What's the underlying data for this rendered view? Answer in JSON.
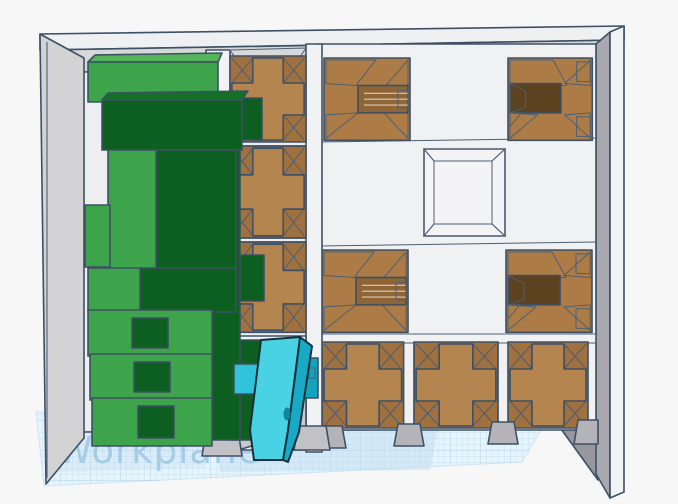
{
  "app": {
    "name": "3d-cad-viewport",
    "background_color": "#f7f7f8",
    "outline_color": "#3d5065"
  },
  "workplane": {
    "label": "Workplane",
    "label_color": "#9dc8e2",
    "grid_line_color": "#bcdcee",
    "grid_base_color": "#e8f4fb"
  },
  "scene": {
    "objects": [
      {
        "name": "storage-tray",
        "description": "open gray tray with compartment grid",
        "wall_color": "#d3d3d5",
        "divider_color": "#f0f1f3"
      },
      {
        "name": "green-stack",
        "description": "stack of interlocking blocks with square holes",
        "light_color": "#3ea44b",
        "dark_color": "#0d5f21"
      },
      {
        "name": "cross-insert",
        "description": "plus-shaped brown inserts in compartments",
        "color": "#b5854f",
        "count": 6
      },
      {
        "name": "socket-block-right-slot",
        "description": "brown block with slot facing right",
        "color": "#ad7c46",
        "count": 2
      },
      {
        "name": "socket-block-left-slot",
        "description": "brown block with dark slot facing left",
        "color": "#ad7c46",
        "cavity_color": "#5d421f",
        "count": 2
      },
      {
        "name": "square-pocket",
        "description": "recessed empty square pocket",
        "wall_color": "#8f8f96"
      },
      {
        "name": "cyan-ramp",
        "description": "cyan angled piece leaning onto workplane",
        "color": "#49d2e4",
        "shade_color": "#18aac4"
      },
      {
        "name": "tan-bar",
        "description": "small tan block behind cyan bar",
        "color": "#d6cba2"
      }
    ]
  }
}
